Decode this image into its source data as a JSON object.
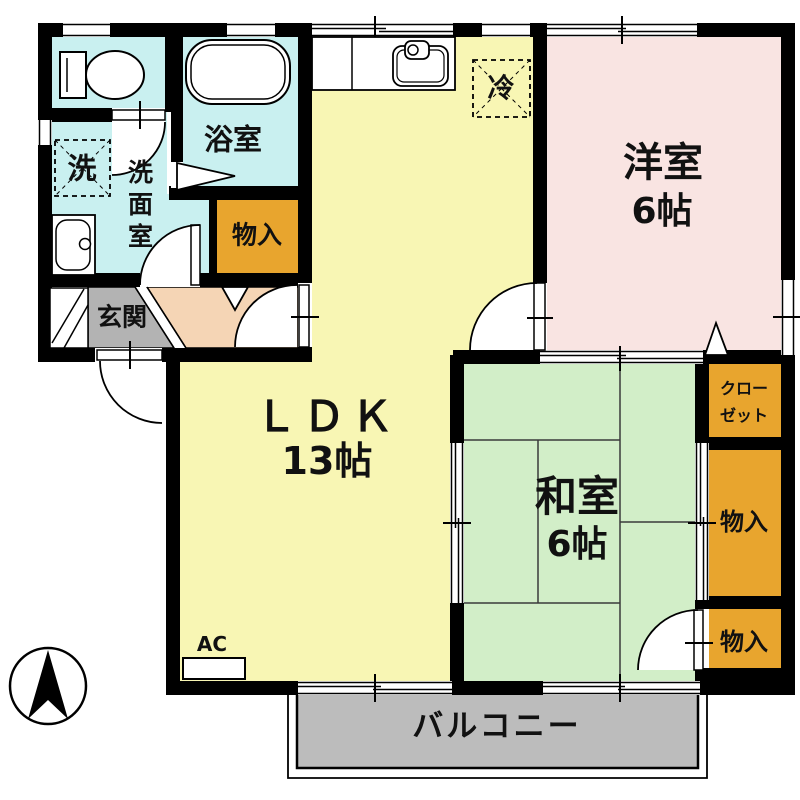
{
  "title": "apartment-floor-plan",
  "colors": {
    "wall": "#000000",
    "water_rooms": "#c9f0f0",
    "ldk": "#f8f6b4",
    "western_room": "#f9e4e2",
    "japanese_room": "#d2eec8",
    "storage": "#e8a52e",
    "balcony": "#bcbcbc",
    "entrance": "#b3b3b3",
    "hall": "#f5d5b5"
  },
  "rooms": {
    "ldk": {
      "label": "ＬＤＫ",
      "size": "13帖"
    },
    "western_room": {
      "label": "洋室",
      "size": "6帖"
    },
    "japanese_room": {
      "label": "和室",
      "size": "6帖"
    },
    "bathroom": {
      "label": "浴室"
    },
    "washroom": {
      "label": "洗面室"
    },
    "laundry": {
      "label": "洗"
    },
    "entrance": {
      "label": "玄関"
    },
    "balcony": {
      "label": "バルコニー"
    },
    "closet": {
      "line1": "クロー",
      "line2": "ゼット"
    },
    "storage_top": {
      "label": "物入"
    },
    "storage_middle": {
      "label": "物入"
    },
    "storage_bottom": {
      "label": "物入"
    },
    "refrigerator": {
      "label": "冷"
    },
    "air_conditioner": {
      "label": "AC"
    }
  }
}
